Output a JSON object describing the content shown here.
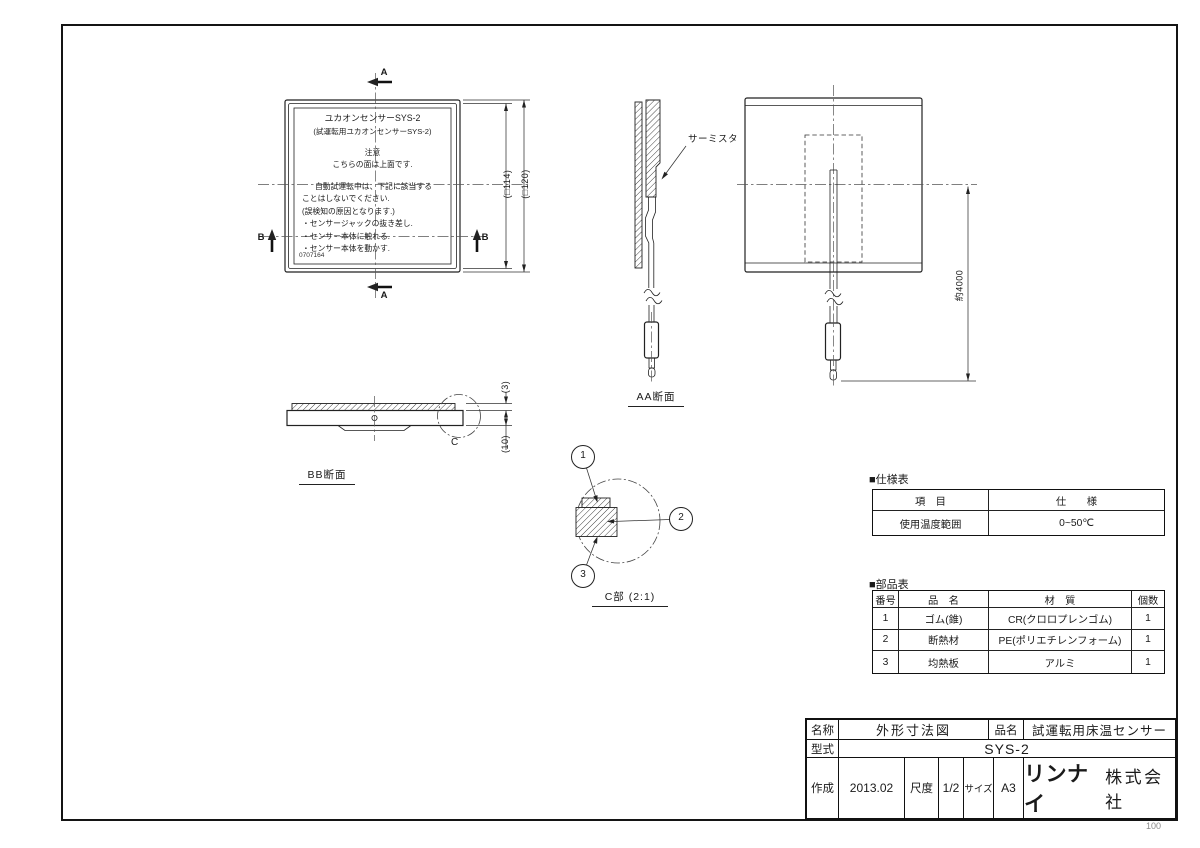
{
  "page": {
    "number": "100"
  },
  "top_view": {
    "sticker": {
      "title": "ユカオンセンサーSYS-2",
      "subtitle": "(試運転用ユカオンセンサーSYS-2)",
      "caution_heading": "注意",
      "caution_line": "こちらの面は上面です.",
      "warning_lines": [
        "自動試運転中は、下記に該当する",
        "ことはしないでください.",
        "(誤検知の原因となります.)"
      ],
      "bullets": [
        "・センサージャックの抜き差し.",
        "・センサー本体に触れる.",
        "・センサー本体を動かす."
      ],
      "code": "0707164"
    },
    "dim_inner": "(□114)",
    "dim_outer": "(□120)",
    "marker_a": "A",
    "marker_b": "B"
  },
  "section_aa": {
    "label": "AA断面",
    "thermistor": "サーミスタ"
  },
  "back_view": {
    "cable_dim": "約4000"
  },
  "section_bb": {
    "label": "BB断面",
    "dim_top": "(3)",
    "dim_bottom": "(10)",
    "detail_marker": "C"
  },
  "detail_c": {
    "label": "C部 (2:1)",
    "balloon_1": "1",
    "balloon_2": "2",
    "balloon_3": "3"
  },
  "spec_table": {
    "heading": "■仕様表",
    "col_item": "項　目",
    "col_spec": "仕　　様",
    "row_item": "使用温度範囲",
    "row_spec": "0~50℃"
  },
  "parts_table": {
    "heading": "■部品表",
    "col_no": "番号",
    "col_name": "品　名",
    "col_material": "材　質",
    "col_qty": "個数",
    "rows": [
      {
        "no": "1",
        "name": "ゴム(錐)",
        "material": "CR(クロロプレンゴム)",
        "qty": "1"
      },
      {
        "no": "2",
        "name": "断熱材",
        "material": "PE(ポリエチレンフォーム)",
        "qty": "1"
      },
      {
        "no": "3",
        "name": "均熱板",
        "material": "アルミ",
        "qty": "1"
      }
    ]
  },
  "title_block": {
    "name_label": "名称",
    "name_value": "外形寸法図",
    "product_label": "品名",
    "product_value": "試運転用床温センサー",
    "model_label": "型式",
    "model_value": "SYS-2",
    "created_label": "作成",
    "created_value": "2013.02",
    "scale_label": "尺度",
    "scale_value": "1/2",
    "size_label": "サイズ",
    "size_value": "A3",
    "company_logo": "リンナイ",
    "company_suffix": "株式会社"
  }
}
